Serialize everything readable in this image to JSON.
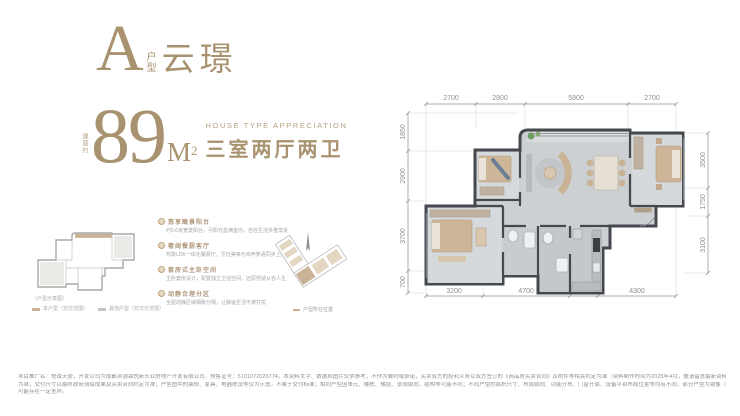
{
  "title": {
    "letter": "A",
    "letter_sub_1": "户",
    "letter_sub_2": "型",
    "name": "云璟"
  },
  "area": {
    "prefix": "建面约",
    "value": "89",
    "unit": "M",
    "unit_sup": "2",
    "en": "HOUSE TYPE APPRECIATION",
    "cn": "三室两厅两卫"
  },
  "keyplan": {
    "legend_title": "（户型示意图）",
    "legend_items": [
      {
        "label": "本户型（交付范围）"
      },
      {
        "label": "其他户型（非交付范围）"
      }
    ]
  },
  "features": [
    {
      "title": "悠享瞰景阳台",
      "desc": "约5.6米宽景阳台，引阳光盈满室内，自在生活多重享受"
    },
    {
      "title": "奢阔餐厨客厅",
      "desc": "构筑LDK一体化餐厨厅，烹饪美味与欢声笑语同步上演"
    },
    {
      "title": "套房式主卧空间",
      "desc": "主卧套房设计，配置独立卫浴空间，还原舒适从容人生"
    },
    {
      "title": "动静合理分区",
      "desc": "全屋动静区域细致分隔，让静谧生活不被打扰"
    }
  ],
  "plate_caption": "户型所在位置",
  "floorplan": {
    "dims_top": [
      "2700",
      "2800",
      "5800",
      "2700"
    ],
    "dims_bottom": [
      "3200",
      "4700",
      "1800",
      "4300"
    ],
    "dims_left": [
      "1850",
      "2900",
      "3700",
      "700"
    ],
    "dims_right": [
      "3500",
      "1750",
      "3100"
    ]
  },
  "colors": {
    "brand_gold": "#a8926f",
    "wall": "#45484d",
    "floor": "#ccd0d3",
    "furniture_tan": "#c9b295",
    "plant_green": "#6f9e62"
  },
  "disclaimer": {
    "line1": "项目推广名：悦璞天骄，开发公司为成都滨潮锦悦新乐业房地产开发有限公司，预售证号：5101072025774。本资料文字、数据和图片仅供参考，不作为要约或承诺，买卖双方的权利义务以双方签订的《商品房买卖合同》及附件等相关约定为准（资料制作时间为2025年4月，敬请留意最新资料）。本户型图所示内容仅供参考，尺寸均须以实测",
    "line2": "为准，交付尺寸以最终政府测绘成果及买卖合同约定为准；户型图中的装修、家具、电器陈设等仅为示意，不属于交付标准；相同户型因单元、楼栋、楼层、景观朝向、结构等可能不同；不同户型的面积尺寸、布局朝向、功能分布、门窗开启、设备平台布局位置等均有不同，部分户型为镜像（反）户型，与实际情况",
    "line3": "可能存在一定差异。"
  }
}
